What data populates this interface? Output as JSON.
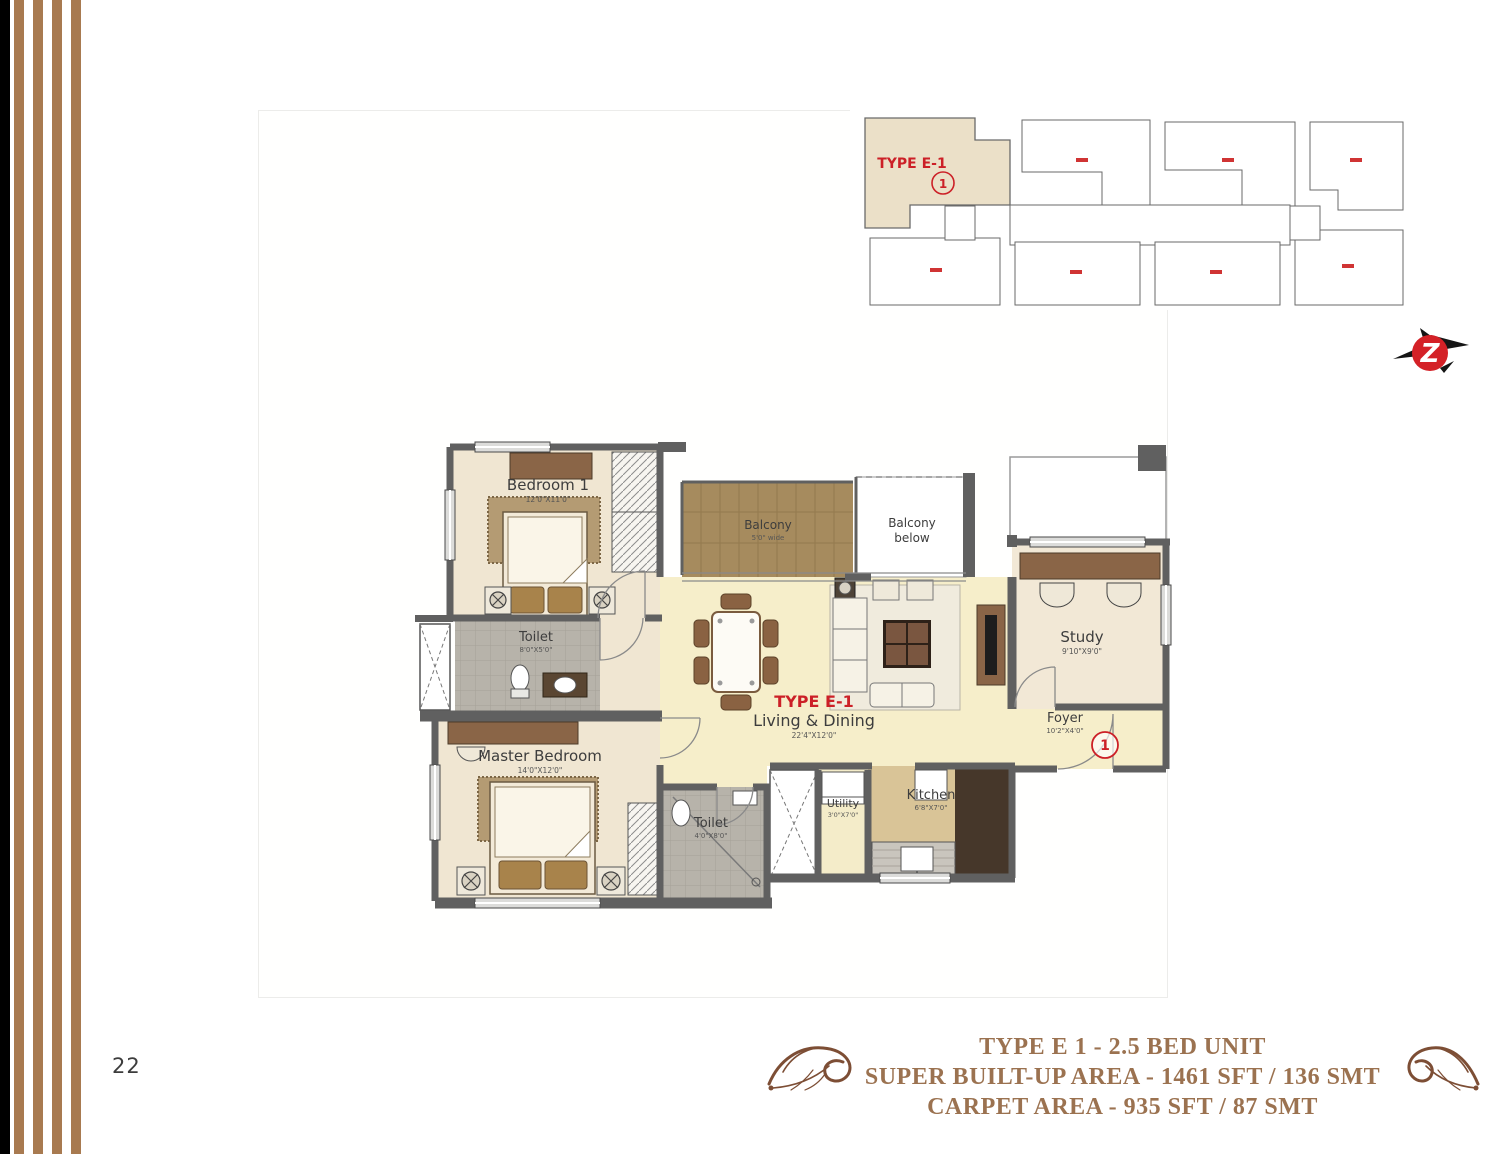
{
  "page": {
    "number": "22"
  },
  "key_plan": {
    "unit_label": "TYPE E-1",
    "unit_number": "1"
  },
  "logo": {
    "letter": "Z"
  },
  "floor_plan": {
    "type_label": "TYPE E-1",
    "unit_number": "1",
    "rooms": {
      "bedroom1": {
        "name": "Bedroom 1",
        "dim": "12'0\"X11'0\""
      },
      "toilet1": {
        "name": "Toilet",
        "dim": "8'0\"X5'0\""
      },
      "master_bedroom": {
        "name": "Master Bedroom",
        "dim": "14'0\"X12'0\""
      },
      "toilet2": {
        "name": "Toilet",
        "dim": "4'0\"X8'0\""
      },
      "balcony": {
        "name": "Balcony",
        "dim": "5'0\" wide"
      },
      "balcony_below": {
        "line1": "Balcony",
        "line2": "below"
      },
      "living_dining": {
        "name": "Living & Dining",
        "dim": "22'4\"X12'0\""
      },
      "study": {
        "name": "Study",
        "dim": "9'10\"X9'0\""
      },
      "foyer": {
        "name": "Foyer",
        "dim": "10'2\"X4'0\""
      },
      "utility": {
        "name": "Utility",
        "dim": "3'0\"X7'0\""
      },
      "kitchen": {
        "name": "Kitchen",
        "dim": "6'8\"X7'0\""
      }
    }
  },
  "footer": {
    "line1": "TYPE E 1 - 2.5 BED UNIT",
    "line2": "SUPER BUILT-UP AREA - 1461 SFT / 136 SMT",
    "line3": "CARPET AREA - 935 SFT / 87 SMT"
  },
  "colors": {
    "accent_red": "#cc2027",
    "title_brown": "#9b7250",
    "stripe_brown": "#a87a50",
    "wall_gray": "#606060",
    "floor_cream": "#f0e6d2",
    "floor_living": "#f6eeca",
    "deck_brown": "#a68b5e",
    "tile_gray": "#b7b3aa",
    "kitchen_tan": "#d9c497",
    "floor_dark": "#46372a"
  }
}
